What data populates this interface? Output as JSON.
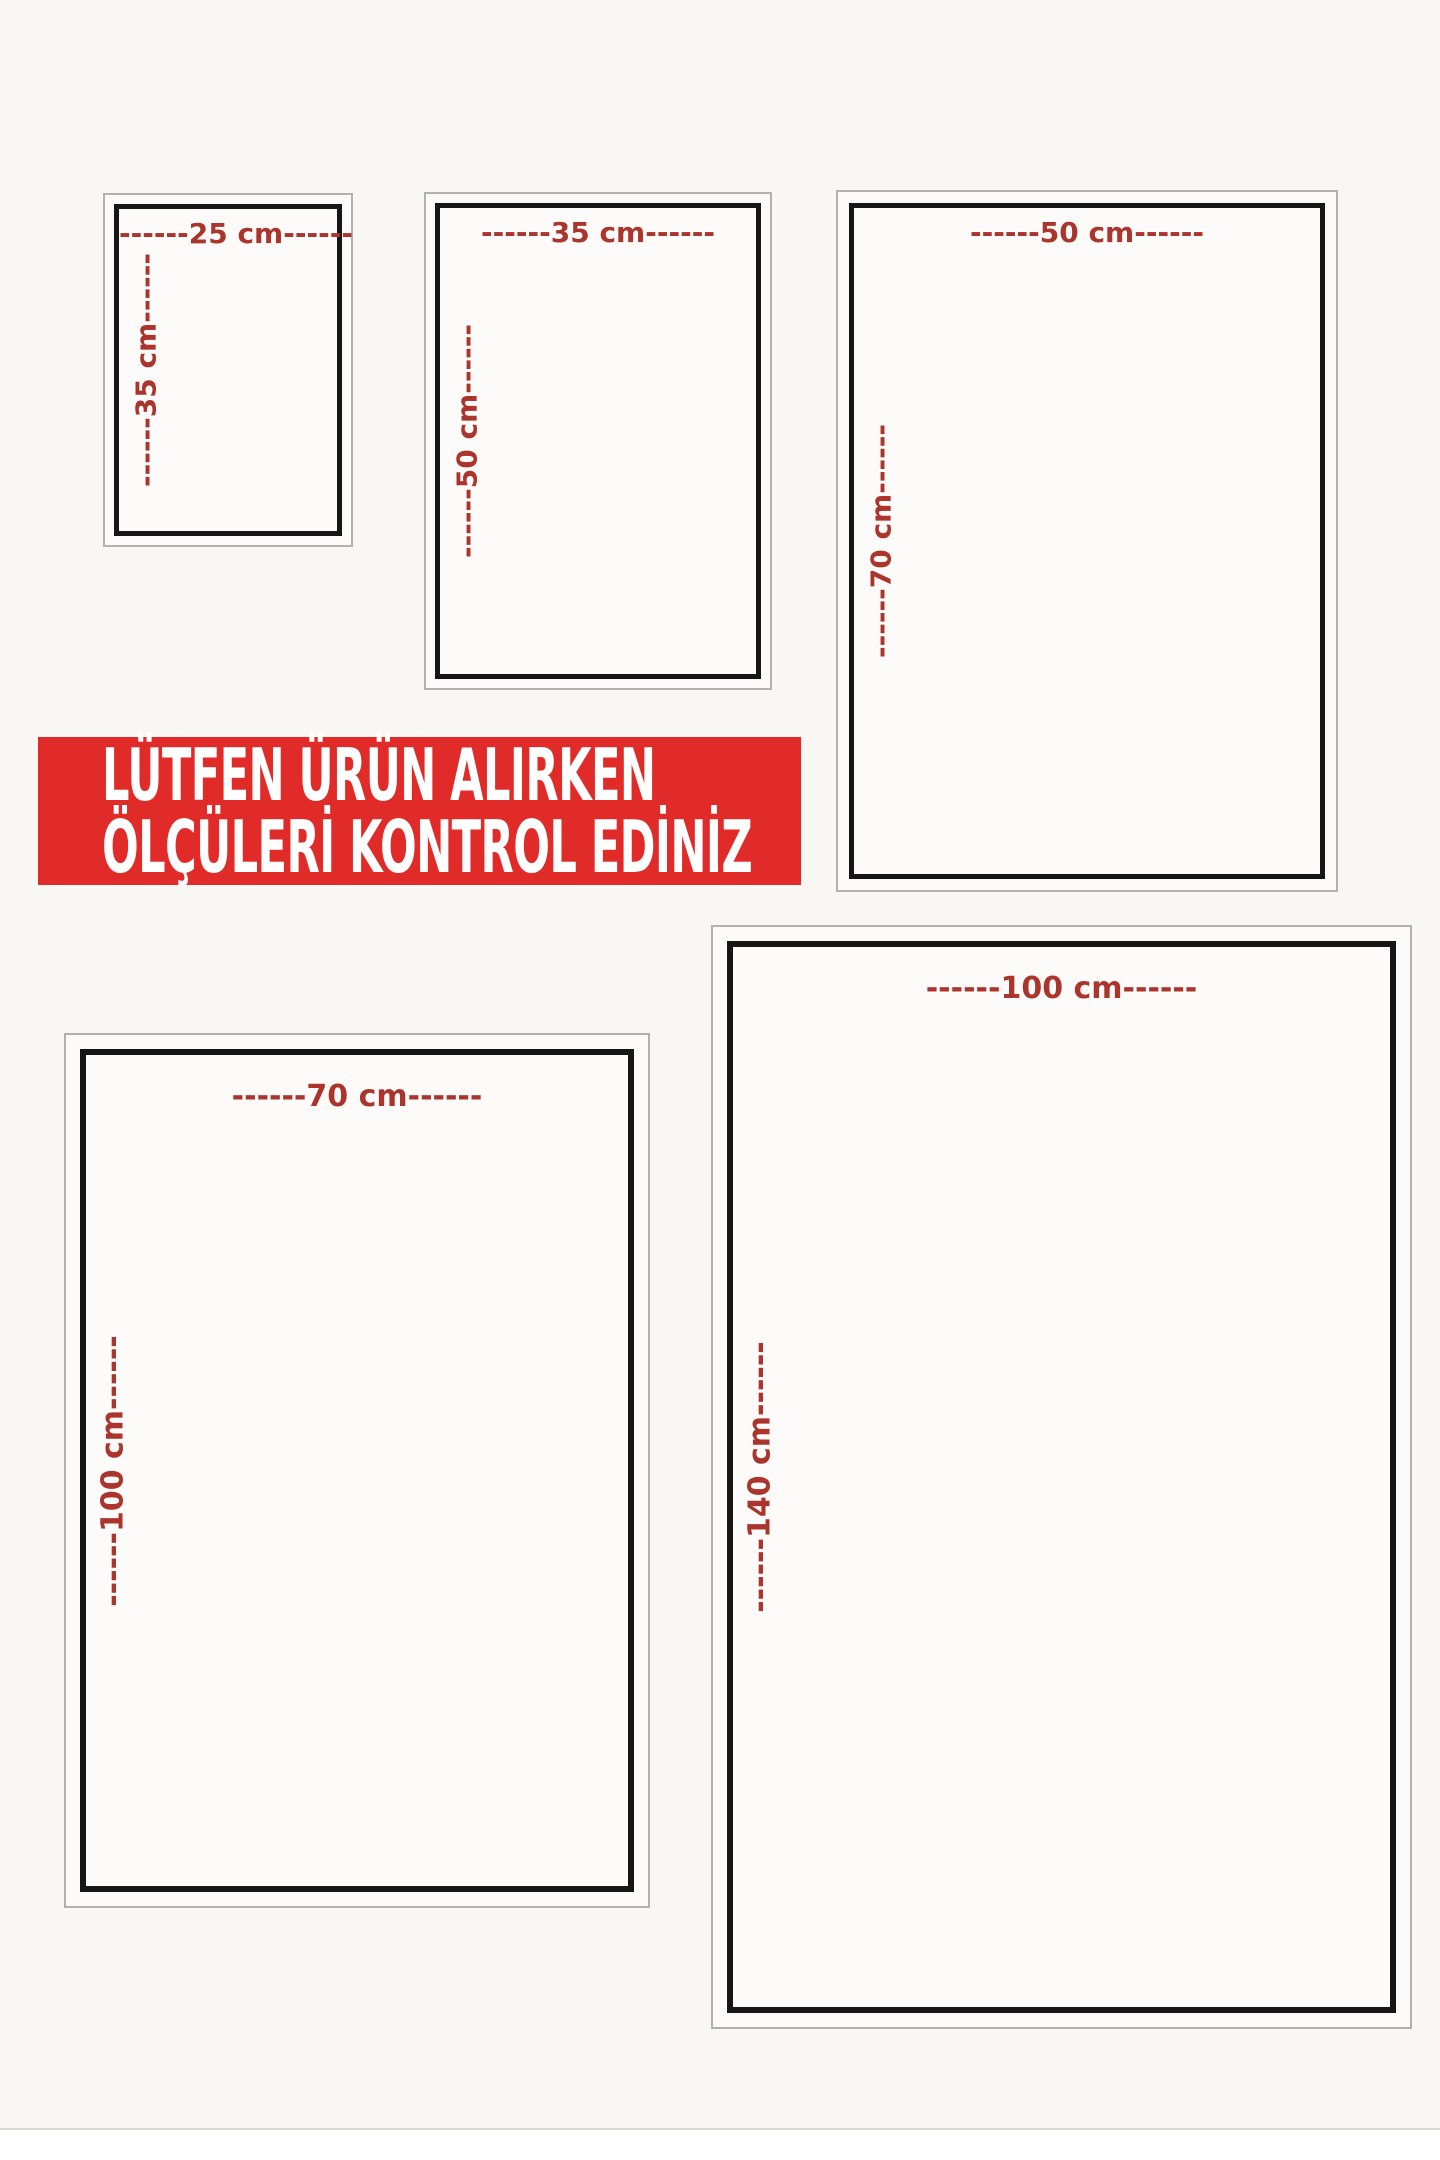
{
  "poster": {
    "banner": {
      "line1": "LÜTFEN ÜRÜN ALIRKEN",
      "line2": "ÖLÇÜLERİ KONTROL EDİNİZ"
    },
    "sizes": [
      {
        "name": "25x35",
        "width_cm": 25,
        "height_cm": 35,
        "width_label": "------25 cm------",
        "height_label": "------35 cm------"
      },
      {
        "name": "35x50",
        "width_cm": 35,
        "height_cm": 50,
        "width_label": "------35 cm------",
        "height_label": "------50 cm------"
      },
      {
        "name": "50x70",
        "width_cm": 50,
        "height_cm": 70,
        "width_label": "------50 cm------",
        "height_label": "------70 cm------"
      },
      {
        "name": "70x100",
        "width_cm": 70,
        "height_cm": 100,
        "width_label": "------70 cm------",
        "height_label": "------100 cm------"
      },
      {
        "name": "100x140",
        "width_cm": 100,
        "height_cm": 140,
        "width_label": "------100 cm------",
        "height_label": "------140 cm------"
      }
    ],
    "colors": {
      "page_bg": "#f8f7f4",
      "banner_bg": "#e12b28",
      "banner_text": "#ffffff",
      "label_red": "#ab352c",
      "frame_border_dark": "#161616",
      "frame_border_light": "#b3b1ad"
    }
  }
}
